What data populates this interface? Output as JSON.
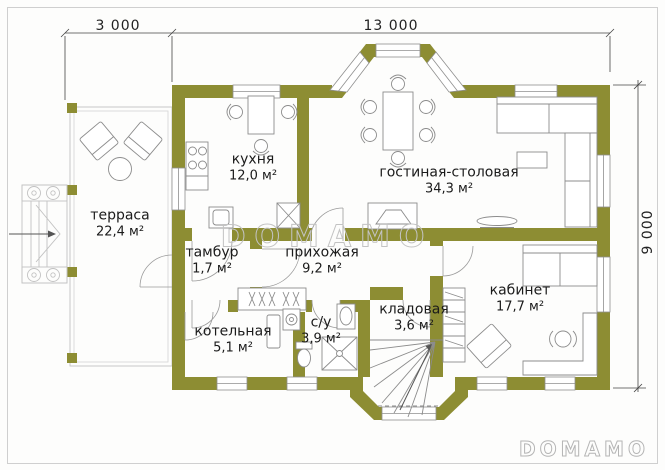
{
  "plan": {
    "dimensions": {
      "terrace_width": "3 000",
      "house_width": "13 000",
      "house_depth": "9 000"
    },
    "rooms": [
      {
        "name": "терраса",
        "area": "22,4 м²"
      },
      {
        "name": "кухня",
        "area": "12,0 м²"
      },
      {
        "name": "гостиная-столовая",
        "area": "34,3 м²"
      },
      {
        "name": "тамбур",
        "area": "1,7 м²"
      },
      {
        "name": "прихожая",
        "area": "9,2 м²"
      },
      {
        "name": "котельная",
        "area": "5,1 м²"
      },
      {
        "name": "с/у",
        "area": "3,9 м²"
      },
      {
        "name": "кладовая",
        "area": "3,6 м²"
      },
      {
        "name": "кабинет",
        "area": "17,7 м²"
      }
    ],
    "watermark_center": "DOMAMO",
    "watermark_corner": "DOMAMO",
    "colors": {
      "wall": "#8d8d33",
      "furniture_line": "#8c8c8c",
      "dimension_line": "#444444",
      "watermark": "#c3c3c3"
    }
  }
}
